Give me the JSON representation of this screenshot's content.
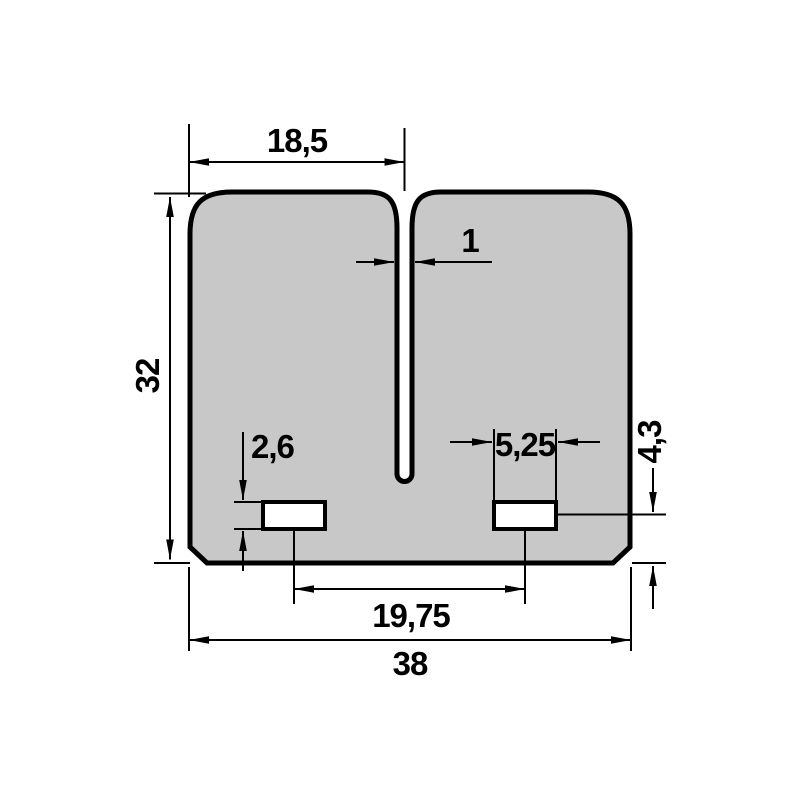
{
  "drawing": {
    "type": "technical-dimension-drawing",
    "part": "twin-petal reed valve plate, front view",
    "background_color": "#ffffff",
    "part_fill_color": "#c8c8c8",
    "line_color": "#000000",
    "dimensions": {
      "petal_width": "18,5",
      "slot_width": "1",
      "total_height": "32",
      "hole_height": "2,6",
      "hole_width": "5,25",
      "hole_center_to_bottom": "4,3",
      "hole_center_spacing": "19,75",
      "total_width": "38"
    }
  }
}
